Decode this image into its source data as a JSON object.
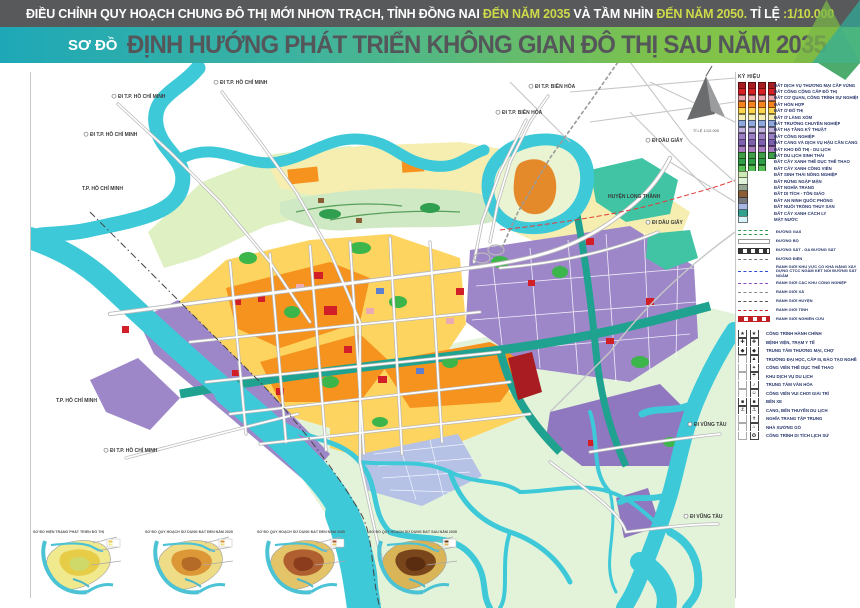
{
  "header": {
    "top_parts": [
      {
        "text": "ĐIỀU CHỈNH QUY HOẠCH CHUNG ĐÔ THỊ MỚI NHƠN TRẠCH, TỈNH ĐỒNG NAI ",
        "color": "#ffffff"
      },
      {
        "text": "ĐẾN NĂM 2035",
        "color": "#cdda49"
      },
      {
        "text": " VÀ TẦM NHÌN ",
        "color": "#ffffff"
      },
      {
        "text": "ĐẾN NĂM 2050.",
        "color": "#cdda49"
      },
      {
        "text": " TỈ LỆ ",
        "color": "#ffffff"
      },
      {
        "text": ":1/10.000",
        "color": "#cdda49"
      }
    ],
    "prefix": "SƠ ĐỒ",
    "title": "ĐỊNH HƯỚNG PHÁT TRIỂN KHÔNG GIAN ĐÔ THỊ SAU NĂM 2035",
    "accent_teal": "#1ea8b7",
    "accent_green": "#8dc63f"
  },
  "compass": {
    "scale_note": "TỈ LỆ 1/10.000"
  },
  "legend": {
    "title": "KÝ HIỆU",
    "land_items": [
      {
        "label": "ĐẤT DỊCH VỤ THƯƠNG MẠI CẤP VÙNG",
        "color": "#a81e23",
        "cols": 4
      },
      {
        "label": "ĐẤT CÔNG CỘNG CẤP ĐÔ THỊ",
        "color": "#d62027",
        "cols": 4
      },
      {
        "label": "ĐẤT CƠ QUAN, CÔNG TRÌNH SỰ NGHIỆP",
        "color": "#eda6ad",
        "cols": 4
      },
      {
        "label": "ĐẤT HỖN HỢP",
        "color": "#f58220",
        "cols": 4
      },
      {
        "label": "ĐẤT Ở ĐÔ THỊ",
        "color": "#fdd44f",
        "cols": 4
      },
      {
        "label": "ĐẤT Ở LÀNG XÓM",
        "color": "#f6efb2",
        "cols": 4
      },
      {
        "label": "ĐẤT TRƯỜNG CHUYÊN NGHIỆP",
        "color": "#8fa8dc",
        "cols": 4
      },
      {
        "label": "ĐẤT HẠ TẦNG KỸ THUẬT",
        "color": "#c3b2dc",
        "cols": 4
      },
      {
        "label": "ĐẤT CÔNG NGHIỆP",
        "color": "#9b7fc4",
        "cols": 4
      },
      {
        "label": "ĐẤT CẢNG VÀ DỊCH VỤ HẬU CẦN CẢNG",
        "color": "#7d5fae",
        "cols": 4
      },
      {
        "label": "ĐẤT KHO ĐÔ THỊ - DU LỊCH",
        "color": "#a87bbd",
        "cols": 4
      },
      {
        "label": "ĐẤT DU LỊCH SINH THÁI",
        "color": "#3f9e47",
        "cols": 4
      },
      {
        "label": "ĐẤT CÂY XANH THỂ DỤC THỂ THAO",
        "color": "#2e9f44",
        "cols": 3
      },
      {
        "label": "ĐẤT CÂY XANH CÔNG VIÊN",
        "color": "#55c054",
        "cols": 3
      },
      {
        "label": "ĐẤT SINH THÁI NÔNG NGHIỆP",
        "color": "#cde8b4",
        "cols": 1
      },
      {
        "label": "ĐẤT RỪNG NGẬP MẶN",
        "color": "#e0f2d8",
        "cols": 1
      },
      {
        "label": "ĐẤT NGHĨA TRANG",
        "color": "#98a694",
        "cols": 1
      },
      {
        "label": "ĐẤT DI TÍCH - TÔN GIÁO",
        "color": "#8a5d35",
        "cols": 1
      },
      {
        "label": "ĐẤT AN NINH QUỐC PHÒNG",
        "color": "#77787b",
        "cols": 1
      },
      {
        "label": "ĐẤT NUÔI TRỒNG THỦY SẢN",
        "color": "#a9b8e3",
        "cols": 1
      },
      {
        "label": "ĐẤT CÂY XANH CÁCH LY",
        "color": "#2fa08c",
        "cols": 1
      },
      {
        "label": "MẶT NƯỚC",
        "color": "#d9f4f8",
        "cols": 1
      }
    ],
    "line_items": [
      {
        "label": "ĐƯỜNG GAS",
        "style": "gas"
      },
      {
        "label": "ĐƯỜNG BỘ",
        "style": "road"
      },
      {
        "label": "ĐƯỜNG SẮT - GA ĐƯỜNG SẮT",
        "style": "rail"
      },
      {
        "label": "ĐƯỜNG ĐIỆN",
        "style": "power"
      },
      {
        "label": "RANH GIỚI KHU VỰC CÓ KHẢ NĂNG XÂY DỰNG CTCC NGẦM KẾT NỐI ĐƯỜNG SẮT NGẦM",
        "style": "metro"
      },
      {
        "label": "RANH GIỚI CÁC KHU CÔNG NGHIỆP",
        "style": "kcn"
      },
      {
        "label": "RANH GIỚI XÃ",
        "style": "xa"
      },
      {
        "label": "RANH GIỚI HUYỆN",
        "style": "huyen"
      },
      {
        "label": "RANH GIỚI TỈNH",
        "style": "tinh"
      },
      {
        "label": "RANH GIỚI NGHIÊN CỨU",
        "style": "nghiencuu"
      }
    ],
    "symbol_items": [
      {
        "label": "CÔNG TRÌNH HÀNH CHÍNH",
        "icon": "★",
        "dual": true
      },
      {
        "label": "BỆNH VIỆN, TRẠM Y TẾ",
        "icon": "✚",
        "dual": true
      },
      {
        "label": "TRUNG TÂM THƯƠNG MẠI, CHỢ",
        "icon": "◆",
        "dual": true
      },
      {
        "label": "TRƯỜNG ĐẠI HỌC, CẤP III, ĐÀO TẠO NGHỀ",
        "icon": "▲",
        "dual": false
      },
      {
        "label": "CÔNG VIÊN THỂ DỤC THỂ THAO",
        "icon": "✦",
        "dual": false
      },
      {
        "label": "KHU DỊCH VỤ DU LỊCH",
        "icon": "☂",
        "dual": false
      },
      {
        "label": "TRUNG TÂM VĂN HÓA",
        "icon": "♪",
        "dual": false
      },
      {
        "label": "CÔNG VIÊN VUI CHƠI GIẢI TRÍ",
        "icon": "☺",
        "dual": false
      },
      {
        "label": "BẾN XE",
        "icon": "■",
        "dual": true
      },
      {
        "label": "CẢNG, BẾN THUYỀN DU LỊCH",
        "icon": "⚓",
        "dual": true
      },
      {
        "label": "NGHĨA TRANG TẬP TRUNG",
        "icon": "✝",
        "dual": false
      },
      {
        "label": "NHÀ XƯỞNG GỖ",
        "icon": "⌂",
        "dual": false
      },
      {
        "label": "CÔNG TRÌNH DI TÍCH LỊCH SỬ",
        "icon": "✪",
        "dual": false
      }
    ]
  },
  "map_labels": [
    {
      "text": "ĐI T.P. HỒ CHÍ MINH",
      "x": 88,
      "y": 36,
      "flag": true
    },
    {
      "text": "ĐI T.P. HỒ CHÍ MINH",
      "x": 190,
      "y": 22,
      "flag": true
    },
    {
      "text": "ĐI T.P. HỒ CHÍ MINH",
      "x": 60,
      "y": 74,
      "flag": true
    },
    {
      "text": "T.P. HỒ CHÍ MINH",
      "x": 52,
      "y": 128,
      "flag": false
    },
    {
      "text": "T.P. HỒ CHÍ MINH",
      "x": 26,
      "y": 340,
      "flag": false
    },
    {
      "text": "ĐI T.P. HỒ CHÍ MINH",
      "x": 80,
      "y": 390,
      "flag": true
    },
    {
      "text": "ĐI T.P. BIÊN HÒA",
      "x": 505,
      "y": 26,
      "flag": true
    },
    {
      "text": "ĐI T.P. BIÊN HÒA",
      "x": 472,
      "y": 52,
      "flag": true
    },
    {
      "text": "ĐI DẦU GIÂY",
      "x": 622,
      "y": 80,
      "flag": true
    },
    {
      "text": "HUYỆN LONG THÀNH",
      "x": 578,
      "y": 136,
      "flag": false
    },
    {
      "text": "ĐI DẦU GIÂY",
      "x": 622,
      "y": 162,
      "flag": true
    },
    {
      "text": "ĐI VŨNG TÀU",
      "x": 664,
      "y": 364,
      "flag": true
    },
    {
      "text": "ĐI VŨNG TÀU",
      "x": 660,
      "y": 456,
      "flag": true
    }
  ],
  "thumbnails": [
    {
      "caption": "SƠ ĐỒ HIỆN TRẠNG PHÁT TRIỂN ĐÔ THỊ",
      "base": "#f0e98e",
      "patch": "#e5c93f",
      "patch2": "#cfd96a"
    },
    {
      "caption": "SƠ ĐỒ QUY HOẠCH SỬ DỤNG ĐẤT ĐẾN NĂM 2025",
      "base": "#eedc86",
      "patch": "#d98f2e",
      "patch2": "#b56b28"
    },
    {
      "caption": "SƠ ĐỒ QUY HOẠCH SỬ DỤNG ĐẤT ĐẾN NĂM 2035",
      "base": "#e3c468",
      "patch": "#a8542a",
      "patch2": "#8a3c1c"
    },
    {
      "caption": "SƠ ĐỒ QUY HOẠCH SỬ DỤNG ĐẤT SAU NĂM 2035",
      "base": "#d9b558",
      "patch": "#6e3a16",
      "patch2": "#5a2c10"
    }
  ]
}
